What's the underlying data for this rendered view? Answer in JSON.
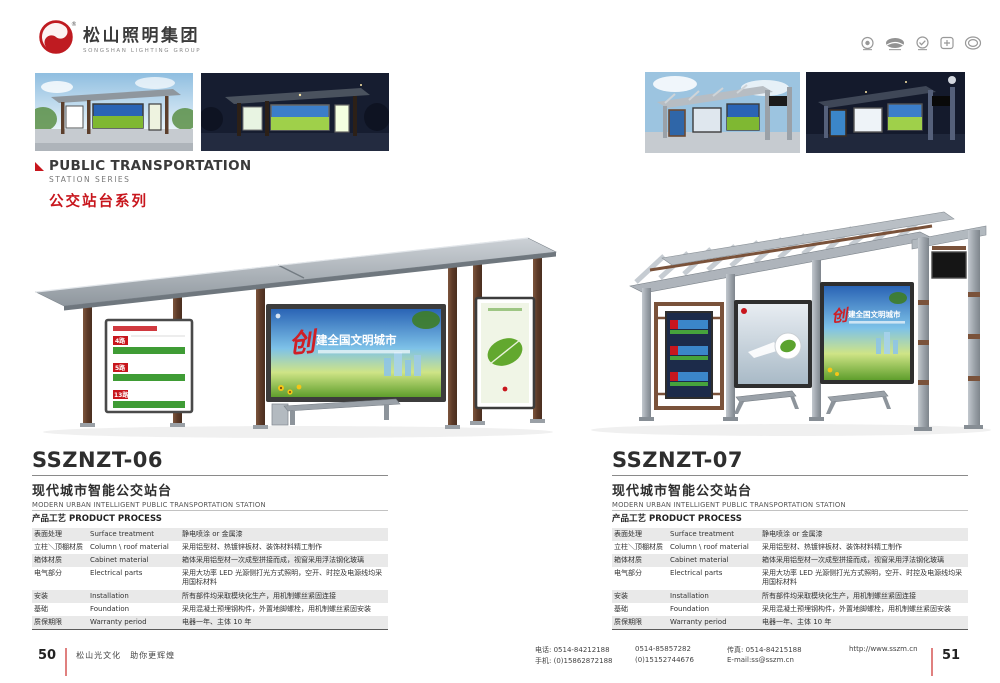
{
  "header": {
    "logo_cn": "松山照明集团",
    "logo_en": "SONGSHAN LIGHTING GROUP",
    "trademark": "®",
    "cert_icons": [
      "cert-badge-1",
      "cert-badge-2",
      "cert-badge-3",
      "cert-badge-4",
      "cert-badge-5"
    ]
  },
  "section": {
    "title_en": "PUBLIC TRANSPORTATION",
    "subtitle_en": "STATION SERIES",
    "title_cn": "公交站台系列"
  },
  "ad": {
    "headline_accent": "创",
    "headline_rest": "建全国文明城市",
    "routes": [
      "4路",
      "5路",
      "13路"
    ]
  },
  "left_page": {
    "page_no": "50",
    "tagline": "松山光文化　助你更辉煌",
    "product_code": "SSZNZT-06",
    "product_name_cn": "现代城市智能公交站台",
    "product_name_en": "MODERN URBAN INTELLIGENT PUBLIC TRANSPORTATION STATION"
  },
  "right_page": {
    "page_no": "51",
    "product_code": "SSZNZT-07",
    "product_name_cn": "现代城市智能公交站台",
    "product_name_en": "MODERN URBAN INTELLIGENT PUBLIC TRANSPORTATION STATION"
  },
  "process_table": {
    "title": "产品工艺 PRODUCT PROCESS",
    "rows": [
      {
        "cn": "表面处理",
        "en": "Surface treatment",
        "desc": "静电喷涂 or 金属漆"
      },
      {
        "cn": "立柱＼顶棚材质",
        "en": "Column \\ roof material",
        "desc": "采用铝型材、热镀锌板材、装饰材料精工制作"
      },
      {
        "cn": "箱体材质",
        "en": "Cabinet material",
        "desc": "箱体采用铝型材一次成型拼接而成，视窗采用浮法钢化玻璃"
      },
      {
        "cn": "电气部分",
        "en": "Electrical parts",
        "desc": "采用大功率 LED 光源侧打光方式照明，空开、时控及电源线均采用国标材料"
      },
      {
        "cn": "安装",
        "en": "Installation",
        "desc": "所有部件均采取模块化生产，用机制螺丝紧固连接"
      },
      {
        "cn": "基础",
        "en": "Foundation",
        "desc": "采用混凝土预埋钢构件，外置地脚螺栓，用机制螺丝紧固安装"
      },
      {
        "cn": "质保期限",
        "en": "Warranty period",
        "desc": "电器一年、主体 10 年"
      }
    ]
  },
  "footer": {
    "tel_label": "电话:",
    "tel_1": "0514-84212188",
    "tel_2": "0514-85857282",
    "fax_label": "传真:",
    "fax": "0514-84215188",
    "website": "http://www.sszm.cn",
    "mobile_label": "手机:",
    "mobile_1": "(0)15862872188",
    "mobile_2": "(0)15152744676",
    "email": "E-mail:ss@sszm.cn"
  },
  "colors": {
    "accent_red": "#c8161d",
    "table_stripe": "#e9e9e9",
    "wood_brown": "#6d4a33",
    "canopy_gray": "#9aa2a8"
  }
}
